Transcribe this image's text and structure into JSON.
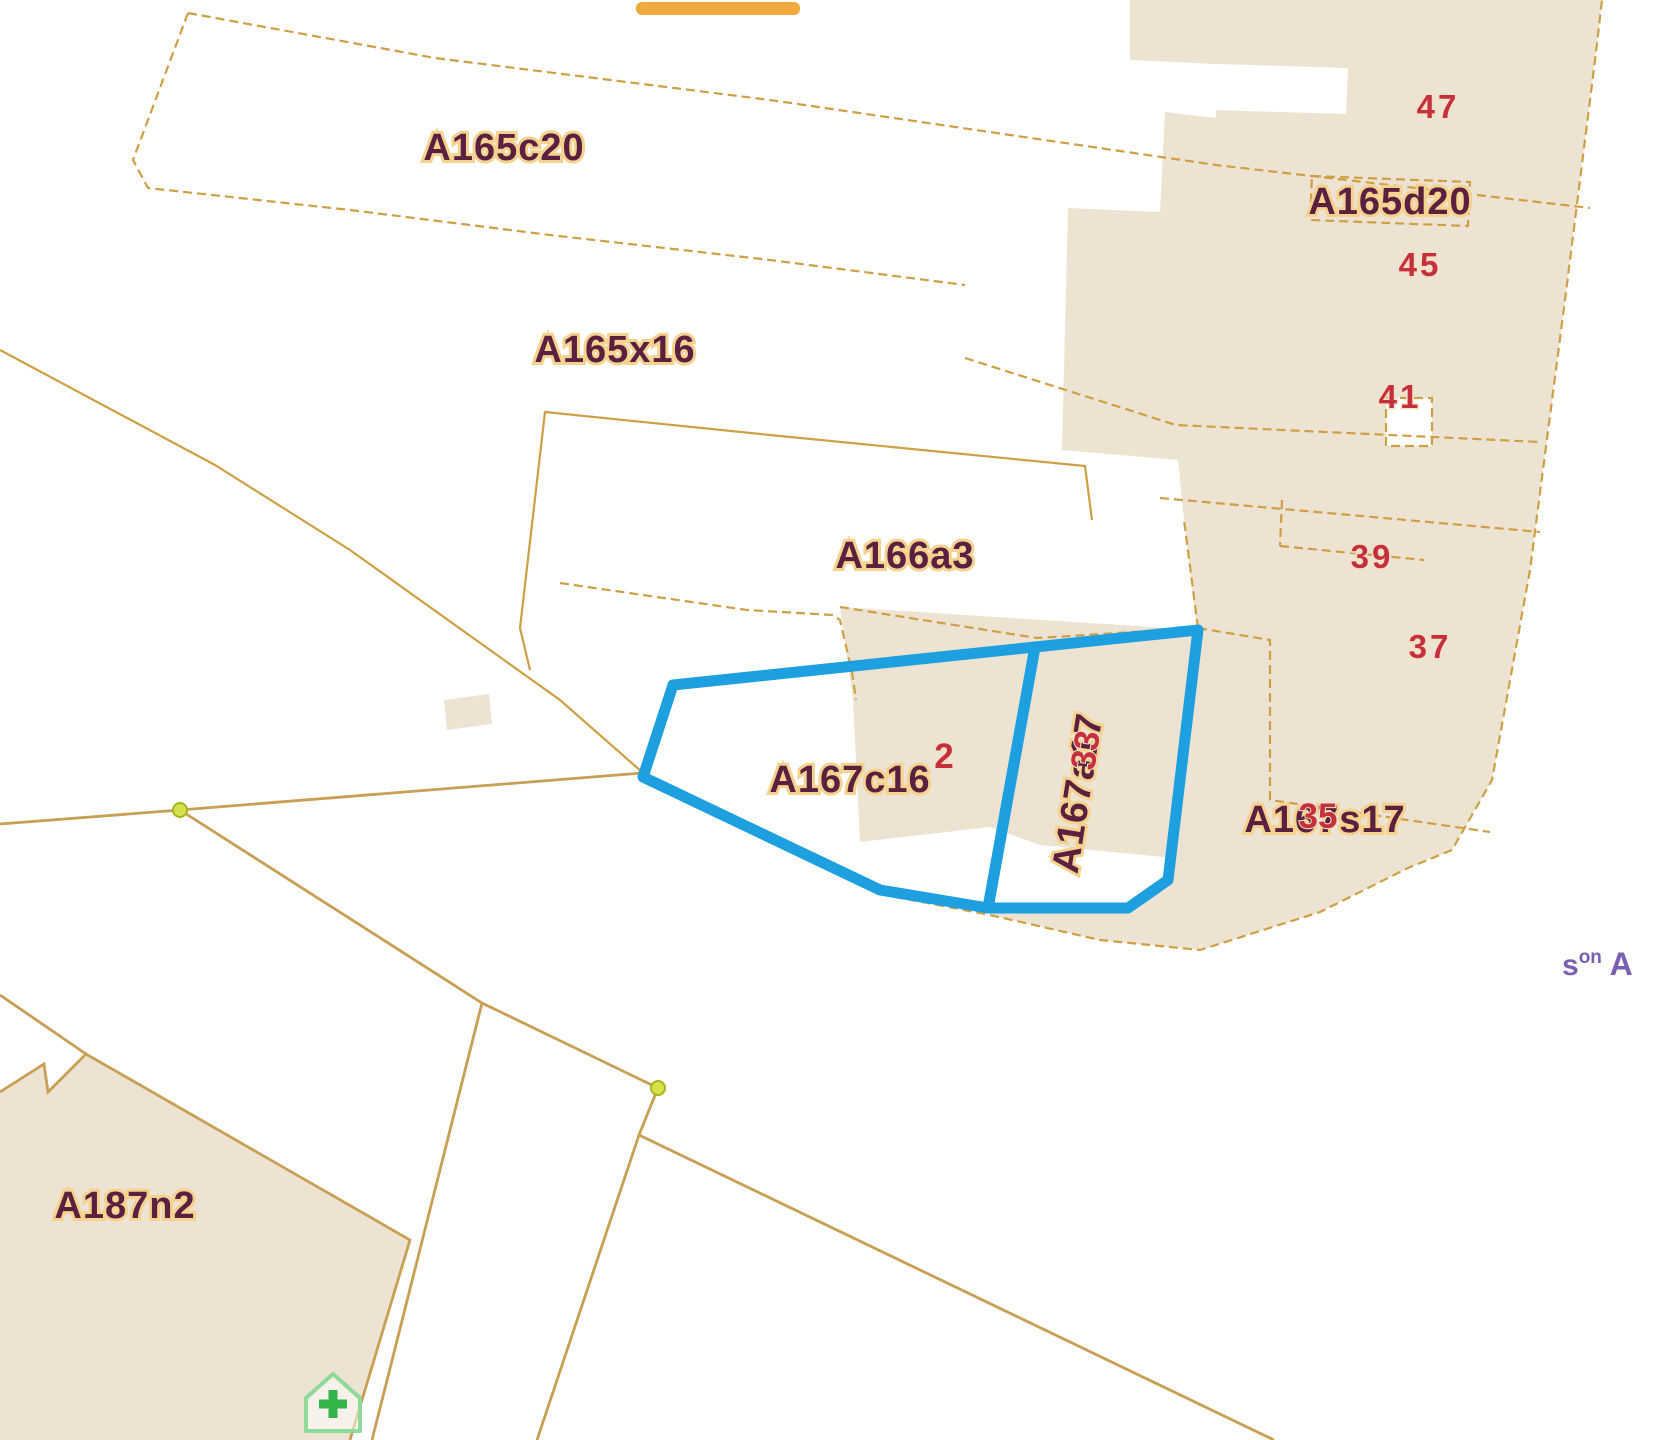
{
  "map": {
    "background_color": "#ffffff",
    "parcel_fill_color": "#ece3d3",
    "boundary_color": "#cf9f45",
    "selection_outline_color": "#1d9fe0",
    "label_color": "#5a2040",
    "label_halo_color": "#f5d28e",
    "house_number_color": "#c5303c",
    "street_text_color": "#7a5fb5",
    "vertex_dot_color": "#d7e24b",
    "home_marker_color": "#33b54a",
    "parcel_labels": {
      "a165c20": "A165c20",
      "a165x16": "A165x16",
      "a166a3": "A166a3",
      "a167c16": "A167c16",
      "a165d20": "A165d20",
      "a167s17": "A167s17",
      "a167a17": "A167a17",
      "a187n2": "A187n2"
    },
    "house_numbers": {
      "n47": "47",
      "n45": "45",
      "n41": "41",
      "n39": "39",
      "n37": "37",
      "n35": "35",
      "n33": "33",
      "n2": "2"
    },
    "street_label": {
      "prefix": "s",
      "superscript": "on",
      "suffix": " A"
    },
    "selected_parcels": [
      "A167c16",
      "A167a17"
    ]
  }
}
